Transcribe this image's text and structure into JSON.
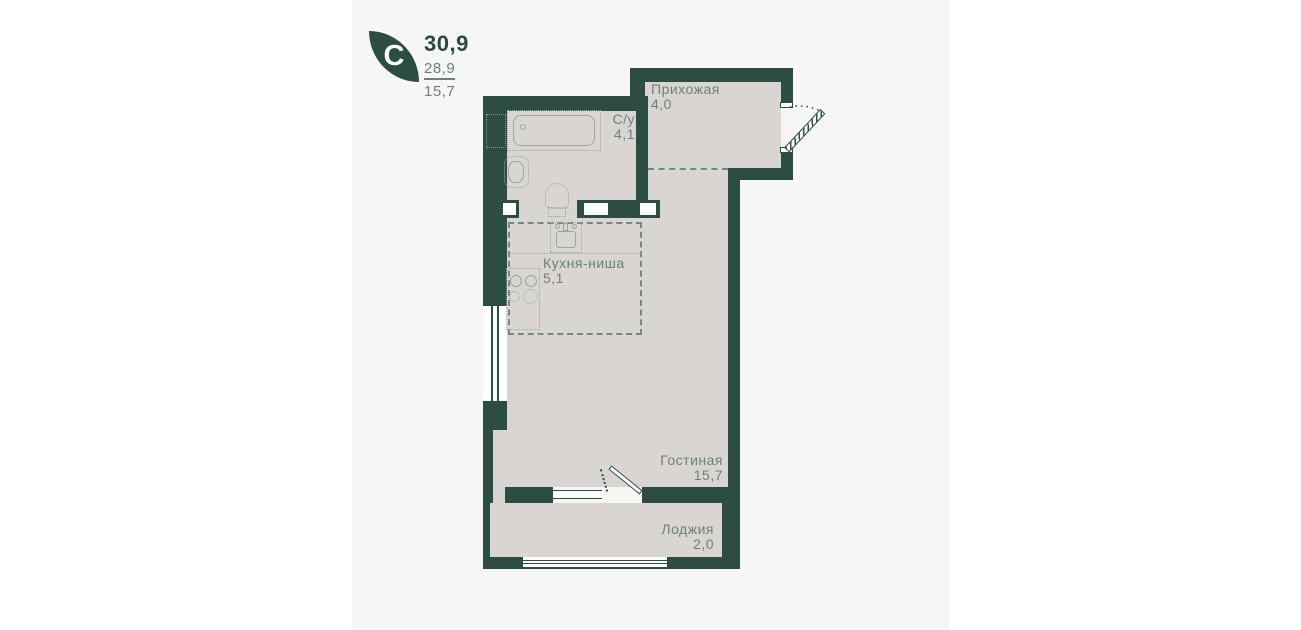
{
  "legend": {
    "letter": "C",
    "total_area": "30,9",
    "second_area": "28,9",
    "third_area": "15,7"
  },
  "rooms": {
    "hallway": {
      "label": "Прихожая",
      "area": "4,0"
    },
    "bathroom": {
      "label": "С/у",
      "area": "4,1"
    },
    "kitchen": {
      "label": "Кухня-ниша",
      "area": "5,1"
    },
    "living": {
      "label": "Гостиная",
      "area": "15,7"
    },
    "loggia": {
      "label": "Лоджия",
      "area": "2,0"
    }
  },
  "colors": {
    "wall": "#2d4c44",
    "floor": "#d8d5d2",
    "panel": "#f6f6f5",
    "label": "#6e8178",
    "fixture": "#9aa79f",
    "dash": "#74897f",
    "accent_dark": "#2e4a40"
  }
}
